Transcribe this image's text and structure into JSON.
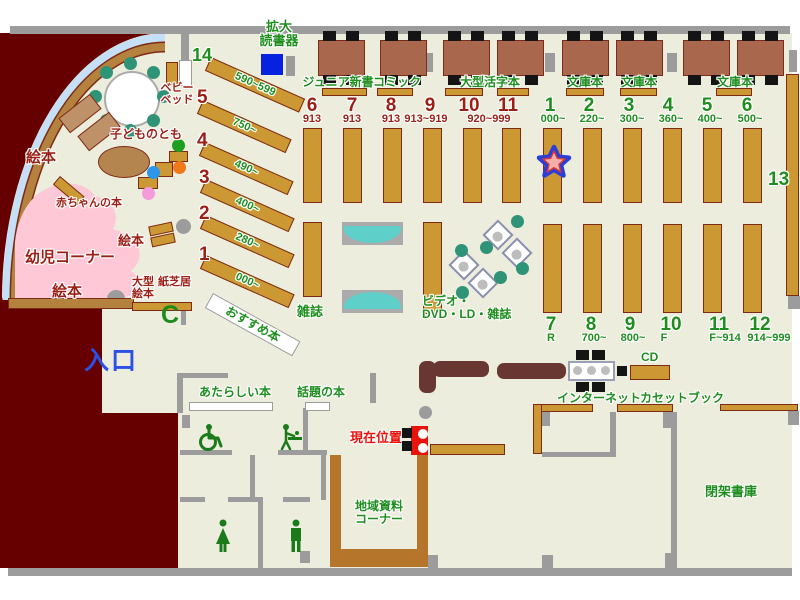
{
  "top_area": {
    "magnifier_label": [
      "拡大",
      "読書器"
    ],
    "shelf_labels": [
      "ジュニア新書",
      "コミック",
      "大型活字本",
      "文庫本",
      "文庫本",
      "文庫本"
    ]
  },
  "left_stacks": {
    "numbers": [
      "6",
      "7",
      "8",
      "9",
      "10",
      "11"
    ],
    "subs": [
      "913",
      "913",
      "913",
      "913~919"
    ],
    "span_sub": "920~999"
  },
  "right_stacks_top": {
    "numbers": [
      "1",
      "2",
      "3",
      "4",
      "5",
      "6"
    ],
    "subs": [
      "000~",
      "220~",
      "300~",
      "360~",
      "400~",
      "500~"
    ]
  },
  "right_stacks_bottom": {
    "numbers": [
      "7",
      "8",
      "9",
      "10",
      "11",
      "12"
    ],
    "subs": [
      "R",
      "700~",
      "800~",
      "F",
      "F~914",
      "914~999"
    ]
  },
  "shelf13_label": "13",
  "children": {
    "diag": [
      {
        "n": "14",
        "range": "590~599"
      },
      {
        "n": "5",
        "range": "750~"
      },
      {
        "n": "4",
        "range": "490~"
      },
      {
        "n": "3",
        "range": "400~"
      },
      {
        "n": "2",
        "range": "280~"
      },
      {
        "n": "1",
        "range": "000~"
      }
    ],
    "labels": {
      "kodomo_no_tomo": "子どものとも",
      "ehon": "絵本",
      "akachan_no_hon": "赤ちゃんの本",
      "yoji_corner": "幼児コーナー",
      "baby_bed": [
        "ベビー",
        "ベッド"
      ],
      "ogata_ehon": [
        "大型",
        "絵本"
      ],
      "kamishibai": "紙芝居",
      "osusume_hon": "おすすめ本"
    }
  },
  "center": {
    "zasshi": "雑誌",
    "video": [
      "ビデオ・",
      "DVD・LD・雑誌"
    ]
  },
  "south": {
    "entrance": "入口",
    "atarashii_hon": "あたらしい本",
    "wadai_no_hon": "話題の本",
    "genzai_ichi": "現在位置",
    "chiiki": [
      "地域資料",
      "コーナー"
    ],
    "cd": "CD",
    "internet": "インターネット",
    "cassette_book": "カセットブック",
    "heika_shoko": "閉架書庫",
    "phone_c": "C"
  },
  "colors": {
    "floor": "#ECEDDD",
    "wall_gray": "#9C9C9C",
    "exterior_maroon": "#660000",
    "shelf_gold": "#CC9833",
    "shelf_border": "#7D2B15",
    "green_text": "#1F8E1F",
    "dark_red_text": "#9C1F15",
    "current_red": "#E8130C",
    "entrance_blue": "#2B50E8",
    "kids_pink": "#FFC8D7",
    "chair_teal": "#2F9377",
    "bench_teal": "#5FCFC9",
    "window_blue": "#C4DFF6"
  }
}
